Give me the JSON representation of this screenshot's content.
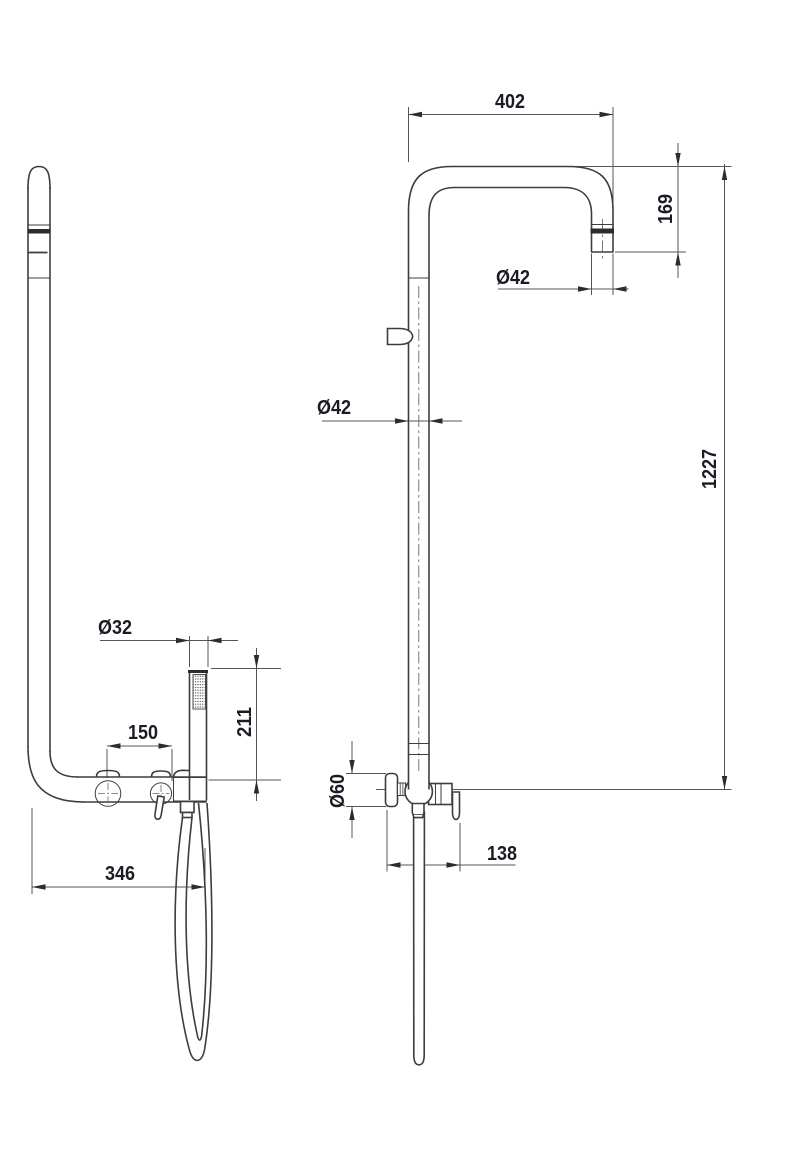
{
  "drawing": {
    "kind": "shower-column-dimension-drawing",
    "dim_labels": {
      "arm_reach": "402",
      "head_drop": "169",
      "head_diameter": "Ø42",
      "riser_diameter": "Ø42",
      "total_height": "1227",
      "escutcheon_diameter": "Ø60",
      "mixer_projection": "138",
      "handshower_diameter": "Ø32",
      "handle_spacing": "150",
      "handshower_height": "211",
      "depth": "346"
    },
    "colors": {
      "background": "#ffffff",
      "object_line": "#3d3d3d",
      "dimension_line": "#555555",
      "label_text": "#1b1b24",
      "solid_band": "#2c2c2c"
    }
  }
}
